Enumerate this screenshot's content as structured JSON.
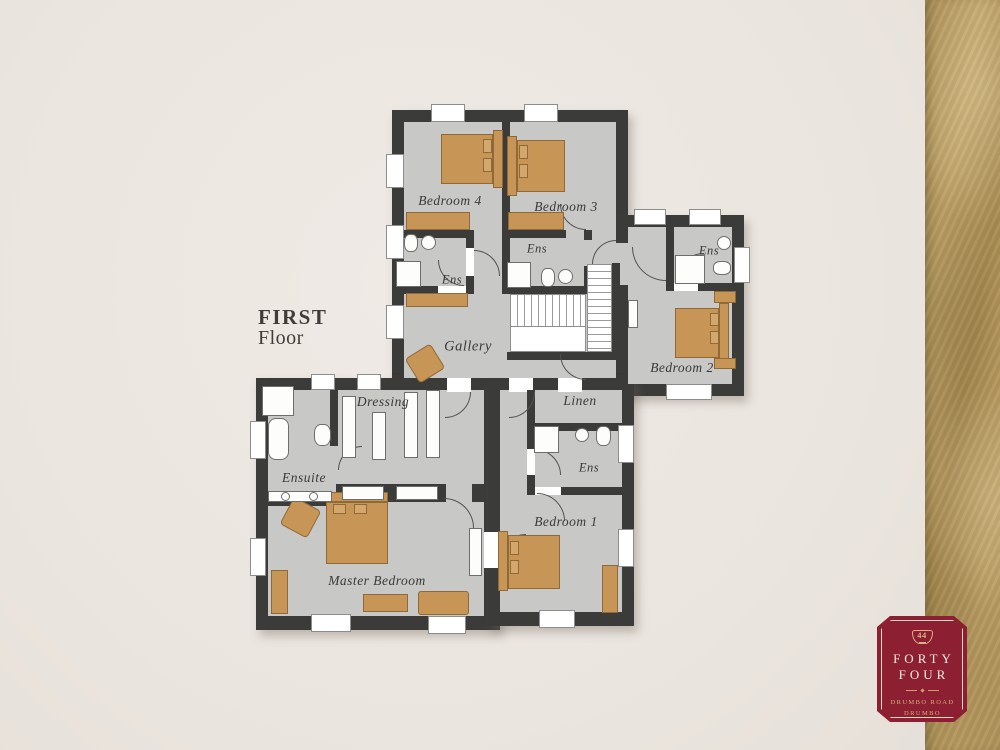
{
  "title": {
    "line1": "FIRST",
    "line2": "Floor"
  },
  "rooms": {
    "bedroom4": "Bedroom 4",
    "bedroom3": "Bedroom 3",
    "bedroom2": "Bedroom 2",
    "bedroom1": "Bedroom 1",
    "master_bedroom": "Master Bedroom",
    "gallery": "Gallery",
    "dressing": "Dressing",
    "ensuite": "Ensuite",
    "linen": "Linen",
    "ens_bedroom4": "Ens",
    "ens_bedroom3": "Ens",
    "ens_bedroom2": "Ens",
    "ens_bedroom1": "Ens"
  },
  "badge": {
    "number": "44",
    "name_line1": "FORTY",
    "name_line2": "FOUR",
    "address_line1": "DRUMBO ROAD",
    "address_line2": "DRUMBO"
  },
  "colors": {
    "background": "#ece7e1",
    "wall": "#3b3b3a",
    "floor": "#c8c9c6",
    "furniture": "#c79556",
    "gold_strip": "#b5985e",
    "badge_red": "#8c1f31",
    "badge_gold": "#d9b183",
    "label_text": "#3a3a38"
  }
}
